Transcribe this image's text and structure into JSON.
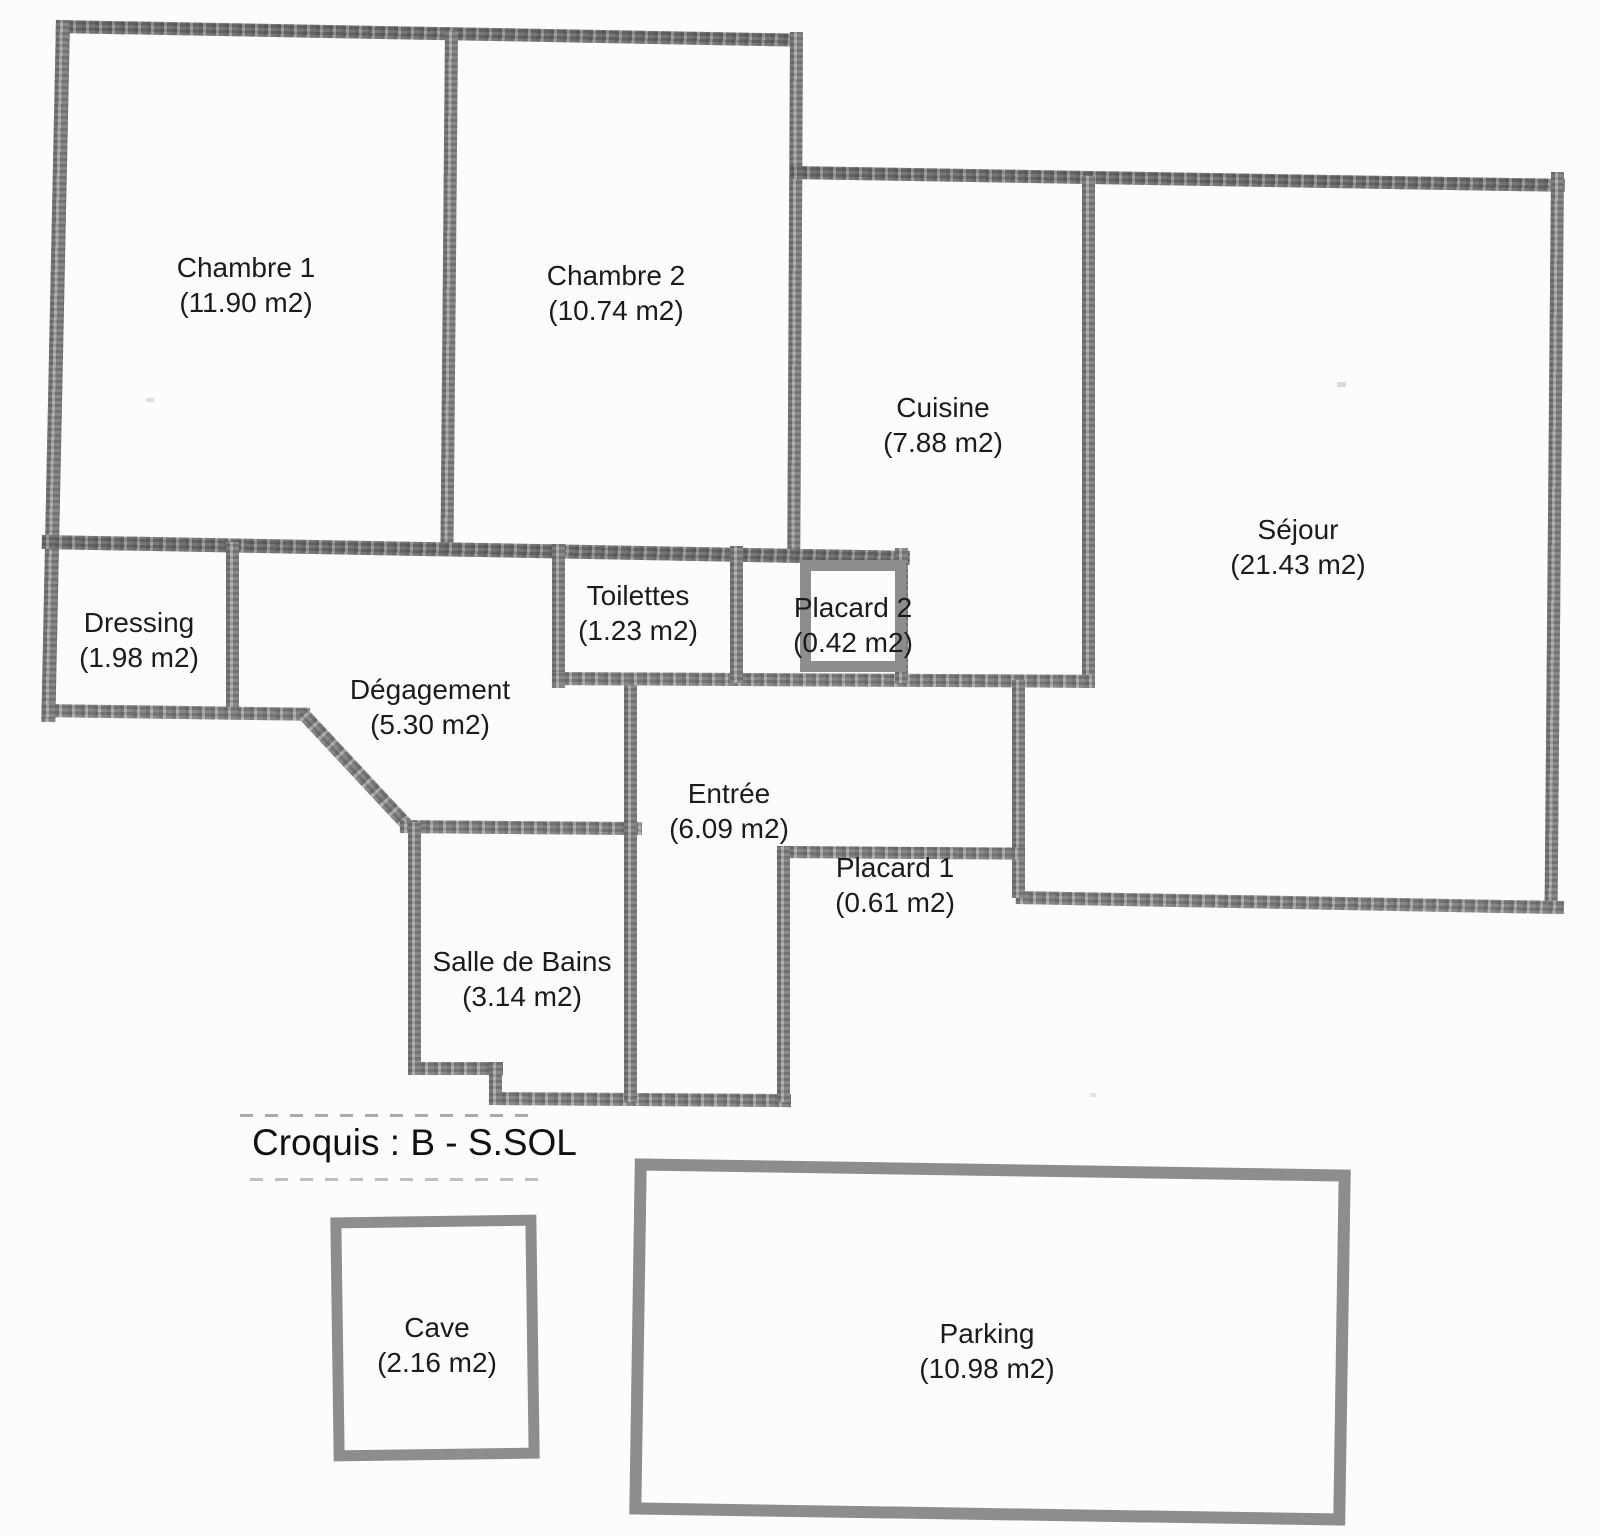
{
  "colors": {
    "wall": "#8d8d8d",
    "wall_dark": "#747474",
    "ink": "#1b1b1b",
    "paper": "#fcfcfb"
  },
  "caption": "Croquis : B - S.SOL",
  "rooms": [
    {
      "id": "chambre-1",
      "name": "Chambre 1",
      "area": "(11.90 m2)"
    },
    {
      "id": "chambre-2",
      "name": "Chambre 2",
      "area": "(10.74 m2)"
    },
    {
      "id": "cuisine",
      "name": "Cuisine",
      "area": "(7.88 m2)"
    },
    {
      "id": "sejour",
      "name": "Séjour",
      "area": "(21.43 m2)"
    },
    {
      "id": "dressing",
      "name": "Dressing",
      "area": "(1.98 m2)"
    },
    {
      "id": "degagement",
      "name": "Dégagement",
      "area": "(5.30 m2)"
    },
    {
      "id": "toilettes",
      "name": "Toilettes",
      "area": "(1.23 m2)"
    },
    {
      "id": "placard-2",
      "name": "Placard 2",
      "area": "(0.42 m2)"
    },
    {
      "id": "entree",
      "name": "Entrée",
      "area": "(6.09 m2)"
    },
    {
      "id": "placard-1",
      "name": "Placard 1",
      "area": "(0.61 m2)"
    },
    {
      "id": "salle-de-bains",
      "name": "Salle de Bains",
      "area": "(3.14 m2)"
    },
    {
      "id": "cave",
      "name": "Cave",
      "area": "(2.16 m2)"
    },
    {
      "id": "parking",
      "name": "Parking",
      "area": "(10.98 m2)"
    }
  ]
}
